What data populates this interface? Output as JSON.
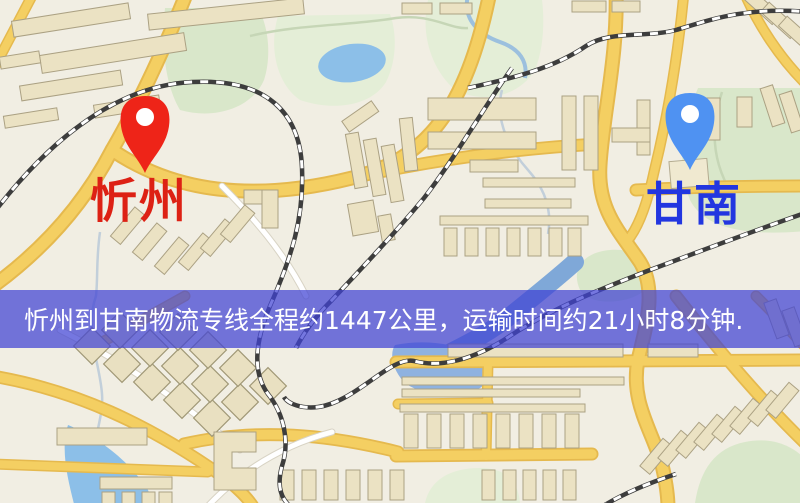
{
  "banner": {
    "text": "忻州到甘南物流专线全程约1447公里，运输时间约21小时8分钟.",
    "background": "#4042d4",
    "opacity": 0.72,
    "text_color": "#ffffff"
  },
  "markers": {
    "origin": {
      "name": "忻州",
      "pin_color": "#ee2418",
      "label_color": "#dd2114"
    },
    "destination": {
      "name": "甘南",
      "pin_color": "#4f92f2",
      "label_color": "#2236e0"
    }
  },
  "map_colors": {
    "background": "#f1eee3",
    "road_major": "#f4cf62",
    "road_casing": "#e5b94e",
    "road_minor": "#ffffff",
    "water": "#8cbfe8",
    "park": "#d9e7ca",
    "building": "#ebe2c3",
    "railway": "#3d3d3d"
  }
}
